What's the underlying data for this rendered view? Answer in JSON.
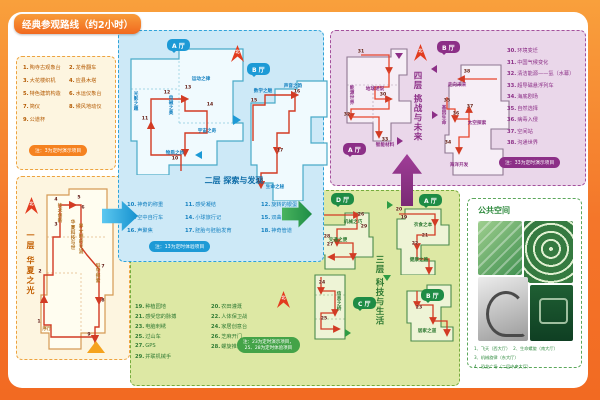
{
  "header": {
    "title": "经典参观路线（约2小时）"
  },
  "colors": {
    "frame_orange": "#f26a22",
    "blue": "#1d9ad6",
    "green": "#44a348",
    "purple": "#8c2f87",
    "route_red": "#d23b24"
  },
  "compass": {
    "north": "北"
  },
  "badges": {
    "a": "A 厅",
    "b": "B 厅",
    "c": "C 厅",
    "d": "D 厅"
  },
  "floors": {
    "f1": {
      "label": "一层 华夏之光"
    },
    "f2": {
      "label": "二层 探索与发现"
    },
    "f3": {
      "label": "三层 科技与生活"
    },
    "f4": {
      "label": "四层 挑战与未来"
    }
  },
  "legends": {
    "f1": {
      "items": [
        {
          "n": "1",
          "t": "陶寺古观象台"
        },
        {
          "n": "2",
          "t": "龙骨翻车"
        },
        {
          "n": "3",
          "t": "大花楼织机"
        },
        {
          "n": "4",
          "t": "应县木塔"
        },
        {
          "n": "5",
          "t": "特色建筑构造"
        },
        {
          "n": "6",
          "t": "水运仪象台"
        },
        {
          "n": "7",
          "t": "简仪"
        },
        {
          "n": "8",
          "t": "候风地动仪"
        },
        {
          "n": "9",
          "t": "公道杯"
        }
      ],
      "note": "注：3为定时演示项目"
    },
    "f2": {
      "items": [
        {
          "n": "10",
          "t": "神奇的称重"
        },
        {
          "n": "11",
          "t": "感受凝结"
        },
        {
          "n": "12",
          "t": "旋转的银蛋"
        },
        {
          "n": "13",
          "t": "空中自行车"
        },
        {
          "n": "14",
          "t": "小球旅行记"
        },
        {
          "n": "15",
          "t": "双曲隧道"
        },
        {
          "n": "16",
          "t": "声聚焦"
        },
        {
          "n": "17",
          "t": "胚胎与胚胎发育"
        },
        {
          "n": "18",
          "t": "神奇管道"
        }
      ],
      "note": "注：13为定时体验项目"
    },
    "f3": {
      "items": [
        {
          "n": "19",
          "t": "种植园地"
        },
        {
          "n": "20",
          "t": "农田灌溉"
        },
        {
          "n": "21",
          "t": "感受您的脉搏"
        },
        {
          "n": "22",
          "t": "人体保卫战"
        },
        {
          "n": "23",
          "t": "电脑刺绣"
        },
        {
          "n": "24",
          "t": "家居创意台"
        },
        {
          "n": "25",
          "t": "过山车"
        },
        {
          "n": "26",
          "t": "芝麻开门"
        },
        {
          "n": "27",
          "t": "GPS"
        },
        {
          "n": "28",
          "t": "螺旋推进器"
        },
        {
          "n": "29",
          "t": "并联机械手"
        }
      ],
      "note_line1": "注：23为定时演示项目，",
      "note_line2": "25、28为定时体验项目"
    },
    "f4": {
      "items": [
        {
          "n": "30",
          "t": "环境变迁"
        },
        {
          "n": "31",
          "t": "中国气候变化"
        },
        {
          "n": "32",
          "t": "清洁能源——氢（水幕）"
        },
        {
          "n": "33",
          "t": "超导磁悬浮列车"
        },
        {
          "n": "34",
          "t": "海底剧场"
        },
        {
          "n": "35",
          "t": "自然选择"
        },
        {
          "n": "36",
          "t": "病毒入侵"
        },
        {
          "n": "37",
          "t": "空间站"
        },
        {
          "n": "38",
          "t": "沟通世界"
        }
      ],
      "note": "注：33为定时演示项目"
    }
  },
  "maps": {
    "f1m": {
      "areas": [
        {
          "t": "序厅",
          "x": 30,
          "y": 152
        },
        {
          "t": "技术创新",
          "x": 42,
          "y": 36,
          "v": 1
        },
        {
          "t": "华夏科技与世",
          "x": 55,
          "y": 58,
          "v": 1
        },
        {
          "t": "界文明的交流",
          "x": 63,
          "y": 62,
          "v": 1
        },
        {
          "t": "科学探索",
          "x": 80,
          "y": 96,
          "v": 1
        }
      ],
      "points": [
        {
          "n": "1",
          "x": 22,
          "y": 145
        },
        {
          "n": "2",
          "x": 23,
          "y": 95
        },
        {
          "n": "3",
          "x": 39,
          "y": 48
        },
        {
          "n": "4",
          "x": 39,
          "y": 23
        },
        {
          "n": "5",
          "x": 62,
          "y": 21
        },
        {
          "n": "6",
          "x": 66,
          "y": 31
        },
        {
          "n": "7",
          "x": 86,
          "y": 90
        },
        {
          "n": "8",
          "x": 86,
          "y": 124
        },
        {
          "n": "9",
          "x": 72,
          "y": 158
        }
      ]
    },
    "f2a": {
      "areas": [
        {
          "t": "光影之趣",
          "x": 10,
          "y": 58,
          "v": 1
        },
        {
          "t": "电磁之奥",
          "x": 45,
          "y": 62,
          "v": 1
        },
        {
          "t": "运动之律",
          "x": 76,
          "y": 36
        },
        {
          "t": "宇宙之奇",
          "x": 82,
          "y": 88
        },
        {
          "t": "物质之妙",
          "x": 50,
          "y": 110
        }
      ],
      "points": [
        {
          "n": "10",
          "x": 50,
          "y": 116
        },
        {
          "n": "11",
          "x": 20,
          "y": 76
        },
        {
          "n": "12",
          "x": 42,
          "y": 50
        },
        {
          "n": "13",
          "x": 63,
          "y": 45
        },
        {
          "n": "14",
          "x": 85,
          "y": 62
        }
      ]
    },
    "f2b": {
      "areas": [
        {
          "t": "数学之魅",
          "x": 16,
          "y": 14
        },
        {
          "t": "声音之韵",
          "x": 46,
          "y": 9
        },
        {
          "t": "生命之秘",
          "x": 28,
          "y": 110
        }
      ],
      "points": [
        {
          "n": "15",
          "x": 7,
          "y": 24
        },
        {
          "n": "16",
          "x": 50,
          "y": 15
        },
        {
          "n": "17",
          "x": 33,
          "y": 74
        },
        {
          "n": "18",
          "x": 13,
          "y": 104
        }
      ]
    },
    "f3d": {
      "areas": [
        {
          "t": "交通之便",
          "x": 27,
          "y": 33
        },
        {
          "t": "机械之巧",
          "x": 42,
          "y": 15
        }
      ],
      "points": [
        {
          "n": "26",
          "x": 50,
          "y": 8
        },
        {
          "n": "29",
          "x": 53,
          "y": 20
        },
        {
          "n": "28",
          "x": 16,
          "y": 30
        },
        {
          "n": "27",
          "x": 19,
          "y": 38
        }
      ]
    },
    "f3a": {
      "areas": [
        {
          "t": "衣食之本",
          "x": 32,
          "y": 20
        },
        {
          "t": "健康之路",
          "x": 28,
          "y": 55
        }
      ],
      "points": [
        {
          "n": "20",
          "x": 8,
          "y": 5
        },
        {
          "n": "19",
          "x": 13,
          "y": 13
        },
        {
          "n": "21",
          "x": 34,
          "y": 31
        },
        {
          "n": "22",
          "x": 24,
          "y": 39
        }
      ]
    },
    "f3c": {
      "areas": [
        {
          "t": "信息之桥",
          "x": 29,
          "y": 30,
          "v": 1
        }
      ],
      "points": [
        {
          "n": "24",
          "x": 13,
          "y": 12
        },
        {
          "n": "25",
          "x": 15,
          "y": 48
        }
      ]
    },
    "f3b": {
      "areas": [
        {
          "t": "居家之道",
          "x": 28,
          "y": 48
        }
      ],
      "points": [
        {
          "n": "23",
          "x": 20,
          "y": 25
        }
      ]
    },
    "f4a": {
      "areas": [
        {
          "t": "能源世界",
          "x": 12,
          "y": 50,
          "v": 1
        },
        {
          "t": "地球述说",
          "x": 36,
          "y": 44
        },
        {
          "t": "智能材料",
          "x": 46,
          "y": 100
        }
      ],
      "points": [
        {
          "n": "31",
          "x": 22,
          "y": 7
        },
        {
          "n": "30",
          "x": 44,
          "y": 50
        },
        {
          "n": "32",
          "x": 8,
          "y": 70
        },
        {
          "n": "33",
          "x": 46,
          "y": 95
        }
      ]
    },
    "f4b": {
      "areas": [
        {
          "t": "走向未来",
          "x": 18,
          "y": 28
        },
        {
          "t": "基因生命",
          "x": 4,
          "y": 58,
          "v": 1
        },
        {
          "t": "太空探索",
          "x": 38,
          "y": 66
        },
        {
          "t": "海洋开发",
          "x": 20,
          "y": 108
        }
      ],
      "points": [
        {
          "n": "38",
          "x": 28,
          "y": 15
        },
        {
          "n": "37",
          "x": 31,
          "y": 50
        },
        {
          "n": "36",
          "x": 17,
          "y": 57
        },
        {
          "n": "35",
          "x": 8,
          "y": 44
        },
        {
          "n": "34",
          "x": 9,
          "y": 86
        }
      ]
    }
  },
  "public_space": {
    "title": "公共空间",
    "items": [
      "1、飞天（西大厅）",
      "2、生命螺旋（南大厅）",
      "3、机械旋律（东大厅）",
      "4、恐龙广场（二层中央大厅）"
    ]
  }
}
